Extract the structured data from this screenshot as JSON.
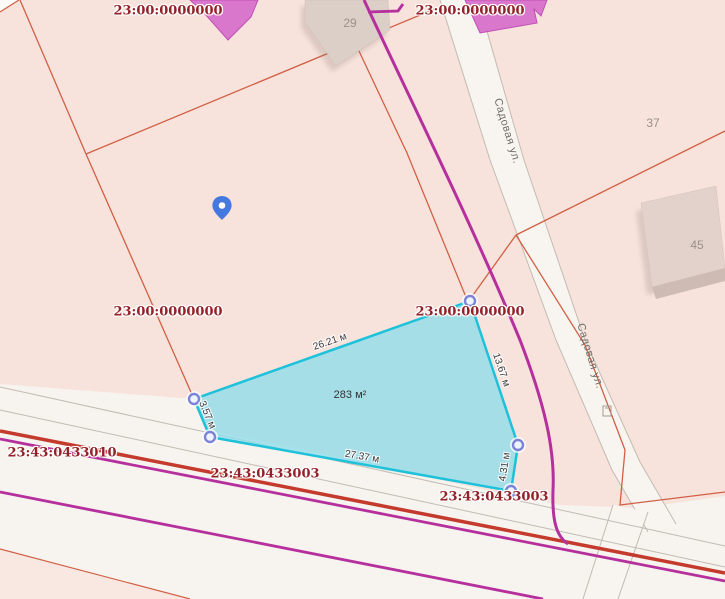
{
  "map": {
    "title": "Cadastral map view",
    "labels": {
      "cadastral": [
        {
          "text": "23:00:0000000"
        },
        {
          "text": "23:00:0000000"
        },
        {
          "text": "23:00:0000000"
        },
        {
          "text": "23:00:0000000"
        },
        {
          "text": "23:43:0433010"
        },
        {
          "text": "23:43:0433003"
        },
        {
          "text": "23:43:0433003"
        }
      ],
      "dimensions": [
        {
          "text": "26.21 м"
        },
        {
          "text": "13.67 м"
        },
        {
          "text": "3.57 м"
        },
        {
          "text": "27.37 м"
        },
        {
          "text": "4.31 м"
        }
      ],
      "streets": [
        {
          "text": "Садовая ул."
        },
        {
          "text": "Садовая ул."
        }
      ],
      "parcel_numbers": [
        {
          "text": "29"
        },
        {
          "text": "37"
        },
        {
          "text": "45"
        }
      ],
      "area": {
        "text": "283 м²"
      }
    },
    "selected_parcel": {
      "area": "283 м²",
      "edge_lengths_m": [
        26.21,
        13.67,
        4.31,
        27.37,
        3.57
      ],
      "vertex_count": 5
    },
    "icons": {
      "pin": "location-pin-icon",
      "vertex": "vertex-handle",
      "pole": "utility-pole-icon"
    },
    "colors": {
      "parcel_fill": "#f8e3dc",
      "road_white": "#f8f5f0",
      "boundary_orange": "#d06044",
      "selection_fill": "#8edcec",
      "selection_stroke": "#1ec1da",
      "vertex_ring": "#7d84d8",
      "cadastral_text": "#932128",
      "road_red": "#c43a2c",
      "road_magenta": "#b52f9d",
      "building_pink": "#d977cd",
      "building_beige": "#dbcfc8",
      "pin_blue": "#4579df"
    }
  }
}
